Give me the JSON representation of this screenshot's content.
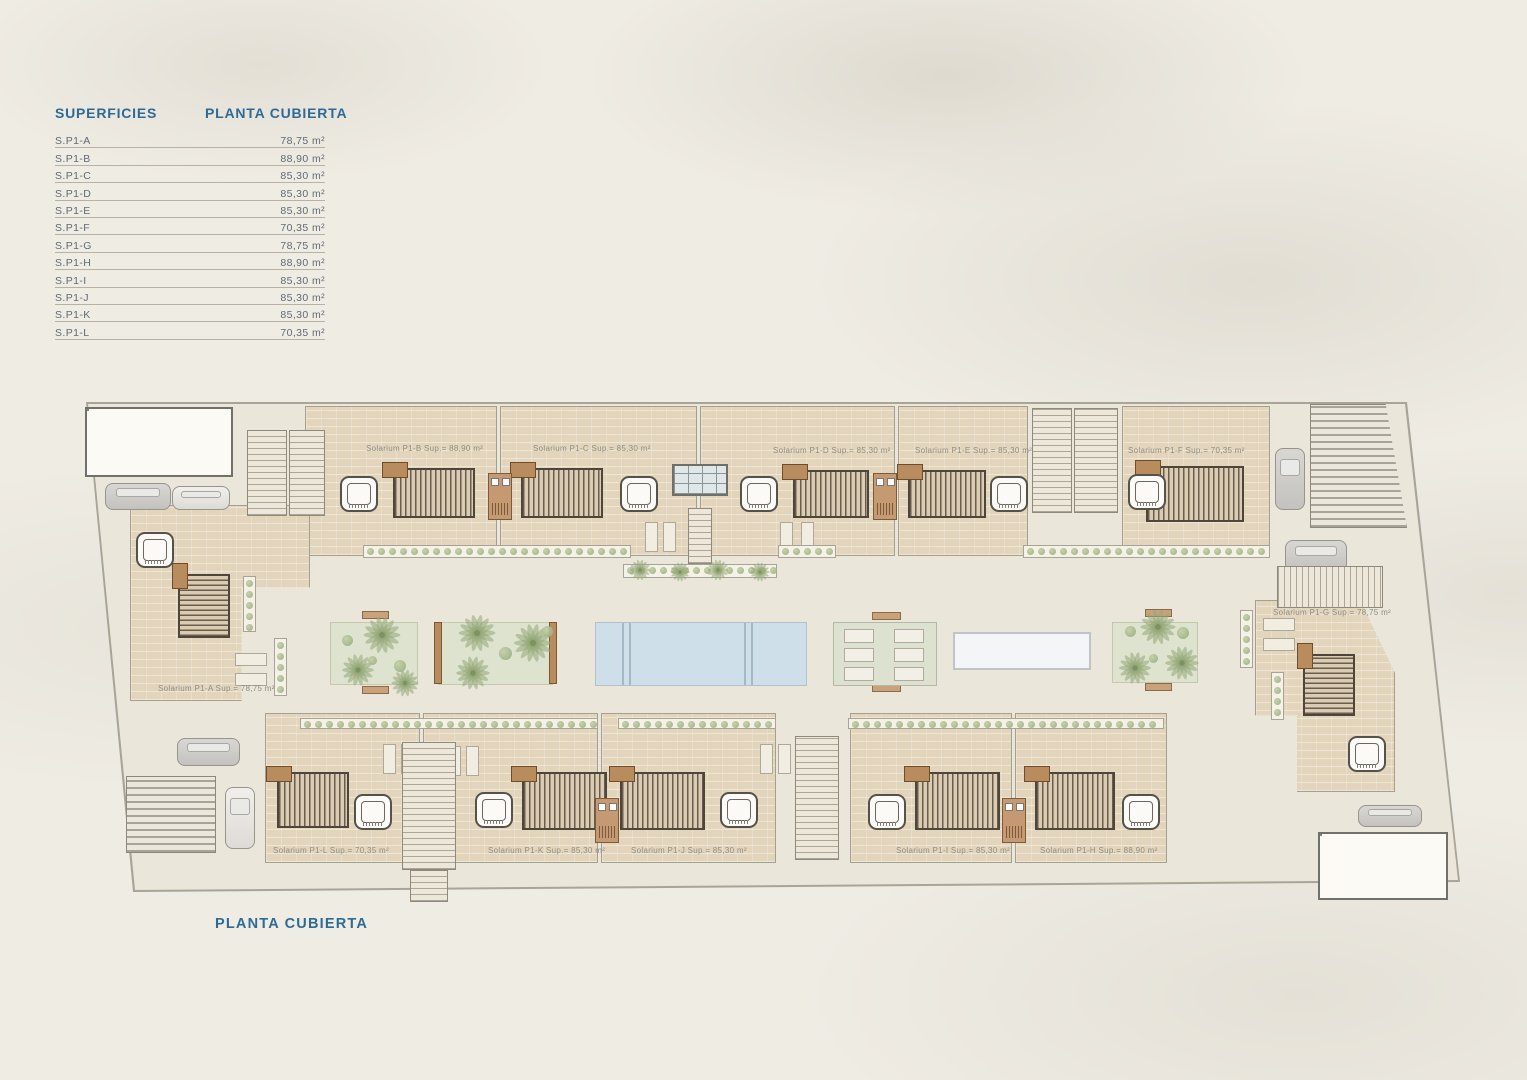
{
  "legend": {
    "title": "SUPERFICIES",
    "column_title": "PLANTA CUBIERTA",
    "rows": [
      {
        "name": "S.P1-A",
        "value": "78,75 m²"
      },
      {
        "name": "S.P1-B",
        "value": "88,90 m²"
      },
      {
        "name": "S.P1-C",
        "value": "85,30 m²"
      },
      {
        "name": "S.P1-D",
        "value": "85,30 m²"
      },
      {
        "name": "S.P1-E",
        "value": "85,30 m²"
      },
      {
        "name": "S.P1-F",
        "value": "70,35 m²"
      },
      {
        "name": "S.P1-G",
        "value": "78,75 m²"
      },
      {
        "name": "S.P1-H",
        "value": "88,90 m²"
      },
      {
        "name": "S.P1-I",
        "value": "85,30 m²"
      },
      {
        "name": "S.P1-J",
        "value": "85,30 m²"
      },
      {
        "name": "S.P1-K",
        "value": "85,30 m²"
      },
      {
        "name": "S.P1-L",
        "value": "70,35 m²"
      }
    ]
  },
  "plan": {
    "title": "PLANTA CUBIERTA",
    "units": [
      {
        "id": "S.P1-A",
        "label": "Solarium P1-A Sup.= 78,75 m²"
      },
      {
        "id": "S.P1-B",
        "label": "Solarium P1-B Sup.= 88,90 m²"
      },
      {
        "id": "S.P1-C",
        "label": "Solarium P1-C Sup.= 85,30 m²"
      },
      {
        "id": "S.P1-D",
        "label": "Solarium P1-D Sup.= 85,30 m²"
      },
      {
        "id": "S.P1-E",
        "label": "Solarium P1-E Sup.= 85,30 m²"
      },
      {
        "id": "S.P1-F",
        "label": "Solarium P1-F Sup.= 70,35 m²"
      },
      {
        "id": "S.P1-G",
        "label": "Solarium P1-G Sup.= 78,75 m²"
      },
      {
        "id": "S.P1-H",
        "label": "Solarium P1-H Sup.= 88,90 m²"
      },
      {
        "id": "S.P1-I",
        "label": "Solarium P1-I Sup.= 85,30 m²"
      },
      {
        "id": "S.P1-J",
        "label": "Solarium P1-J Sup.= 85,30 m²"
      },
      {
        "id": "S.P1-K",
        "label": "Solarium P1-K Sup.= 85,30 m²"
      },
      {
        "id": "S.P1-L",
        "label": "Solarium P1-L Sup.= 70,35 m²"
      }
    ]
  },
  "palette": {
    "accent_blue": "#2d6b96",
    "table_text": "#5f6b76",
    "plan_label": "#8e8d85",
    "plate": "#eae6d9",
    "stone": "#e3d5bb",
    "garden": "#dee3cf",
    "pool": "#cfdfe9",
    "wood": "#b98c5e",
    "solar": "#cbd3db"
  }
}
